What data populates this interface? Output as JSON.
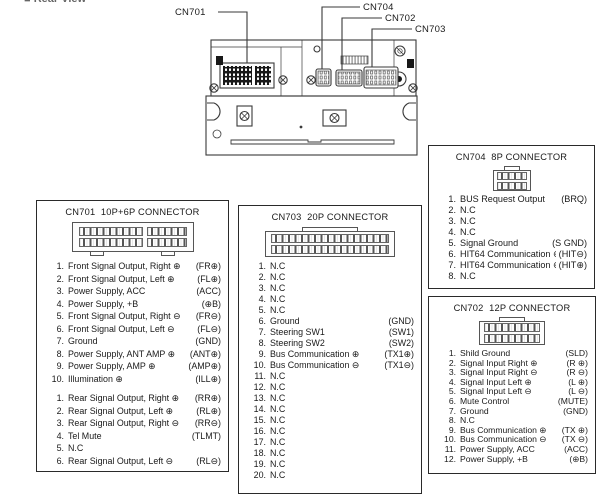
{
  "rear_view": {
    "label": "Rear View"
  },
  "callouts": {
    "cn701": "CN701",
    "cn704": "CN704",
    "cn702": "CN702",
    "cn703": "CN703"
  },
  "cn701": {
    "title": "CN701  10P+6P CONNECTOR",
    "pins_main": [
      {
        "num": "1.",
        "label": "Front Signal Output, Right ⊕",
        "code": "(FR⊕)"
      },
      {
        "num": "2.",
        "label": "Front Signal Output, Left ⊕",
        "code": "(FL⊕)"
      },
      {
        "num": "3.",
        "label": "Power Supply, ACC",
        "code": "(ACC)"
      },
      {
        "num": "4.",
        "label": "Power Supply, +B",
        "code": "(⊕B)"
      },
      {
        "num": "5.",
        "label": "Front Signal Output, Right ⊖",
        "code": "(FR⊖)"
      },
      {
        "num": "6.",
        "label": "Front Signal Output, Left ⊖",
        "code": "(FL⊖)"
      },
      {
        "num": "7.",
        "label": "Ground",
        "code": "(GND)"
      },
      {
        "num": "8.",
        "label": "Power Supply, ANT AMP ⊕",
        "code": "(ANT⊕)"
      },
      {
        "num": "9.",
        "label": "Power Supply, AMP ⊕",
        "code": "(AMP⊕)"
      },
      {
        "num": "10.",
        "label": "Illumination ⊕",
        "code": "(ILL⊕)"
      }
    ],
    "pins_sub": [
      {
        "num": "1.",
        "label": "Rear Signal Output, Right ⊕",
        "code": "(RR⊕)"
      },
      {
        "num": "2.",
        "label": "Rear Signal Output, Left ⊕",
        "code": "(RL⊕)"
      },
      {
        "num": "3.",
        "label": "Rear Signal Output, Right ⊖",
        "code": "(RR⊖)"
      },
      {
        "num": "4.",
        "label": "Tel Mute",
        "code": "(TLMT)"
      },
      {
        "num": "5.",
        "label": "N.C",
        "code": ""
      },
      {
        "num": "6.",
        "label": "Rear Signal Output, Left ⊖",
        "code": "(RL⊖)"
      }
    ]
  },
  "cn703": {
    "title": "CN703  20P CONNECTOR",
    "pins": [
      {
        "num": "1.",
        "label": "N.C",
        "code": ""
      },
      {
        "num": "2.",
        "label": "N.C",
        "code": ""
      },
      {
        "num": "3.",
        "label": "N.C",
        "code": ""
      },
      {
        "num": "4.",
        "label": "N.C",
        "code": ""
      },
      {
        "num": "5.",
        "label": "N.C",
        "code": ""
      },
      {
        "num": "6.",
        "label": "Ground",
        "code": "(GND)"
      },
      {
        "num": "7.",
        "label": "Steering SW1",
        "code": "(SW1)"
      },
      {
        "num": "8.",
        "label": "Steering SW2",
        "code": "(SW2)"
      },
      {
        "num": "9.",
        "label": "Bus Communication ⊕",
        "code": "(TX1⊕)"
      },
      {
        "num": "10.",
        "label": "Bus Communication ⊖",
        "code": "(TX1⊖)"
      },
      {
        "num": "11.",
        "label": "N.C",
        "code": ""
      },
      {
        "num": "12.",
        "label": "N.C",
        "code": ""
      },
      {
        "num": "13.",
        "label": "N.C",
        "code": ""
      },
      {
        "num": "14.",
        "label": "N.C",
        "code": ""
      },
      {
        "num": "15.",
        "label": "N.C",
        "code": ""
      },
      {
        "num": "16.",
        "label": "N.C",
        "code": ""
      },
      {
        "num": "17.",
        "label": "N.C",
        "code": ""
      },
      {
        "num": "18.",
        "label": "N.C",
        "code": ""
      },
      {
        "num": "19.",
        "label": "N.C",
        "code": ""
      },
      {
        "num": "20.",
        "label": "N.C",
        "code": ""
      }
    ]
  },
  "cn704": {
    "title": "CN704  8P CONNECTOR",
    "pins": [
      {
        "num": "1.",
        "label": "BUS Request Output",
        "code": "(BRQ)"
      },
      {
        "num": "2.",
        "label": "N.C",
        "code": ""
      },
      {
        "num": "3.",
        "label": "N.C",
        "code": ""
      },
      {
        "num": "4.",
        "label": "N.C",
        "code": ""
      },
      {
        "num": "5.",
        "label": "Signal Ground",
        "code": "(S GND)"
      },
      {
        "num": "6.",
        "label": "HIT64 Communication ⊖",
        "code": "(HIT⊖)"
      },
      {
        "num": "7.",
        "label": "HIT64 Communication ⊕",
        "code": "(HIT⊕)"
      },
      {
        "num": "8.",
        "label": "N.C",
        "code": ""
      }
    ]
  },
  "cn702": {
    "title": "CN702  12P CONNECTOR",
    "pins": [
      {
        "num": "1.",
        "label": "Shild Ground",
        "code": "(SLD)"
      },
      {
        "num": "2.",
        "label": "Signal Input Right ⊕",
        "code": "(R ⊕)"
      },
      {
        "num": "3.",
        "label": "Signal Input Right ⊖",
        "code": "(R ⊖)"
      },
      {
        "num": "4.",
        "label": "Signal Input Left ⊕",
        "code": "(L ⊕)"
      },
      {
        "num": "5.",
        "label": "Signal Input Left ⊖",
        "code": "(L ⊖)"
      },
      {
        "num": "6.",
        "label": "Mute Control",
        "code": "(MUTE)"
      },
      {
        "num": "7.",
        "label": "Ground",
        "code": "(GND)"
      },
      {
        "num": "8.",
        "label": "N.C",
        "code": ""
      },
      {
        "num": "9.",
        "label": "Bus Communication ⊕",
        "code": "(TX ⊕)"
      },
      {
        "num": "10.",
        "label": "Bus Communication ⊖",
        "code": "(TX ⊖)"
      },
      {
        "num": "11.",
        "label": "Power Supply, ACC",
        "code": "(ACC)"
      },
      {
        "num": "12.",
        "label": "Power Supply, +B",
        "code": "(⊕B)"
      }
    ]
  }
}
